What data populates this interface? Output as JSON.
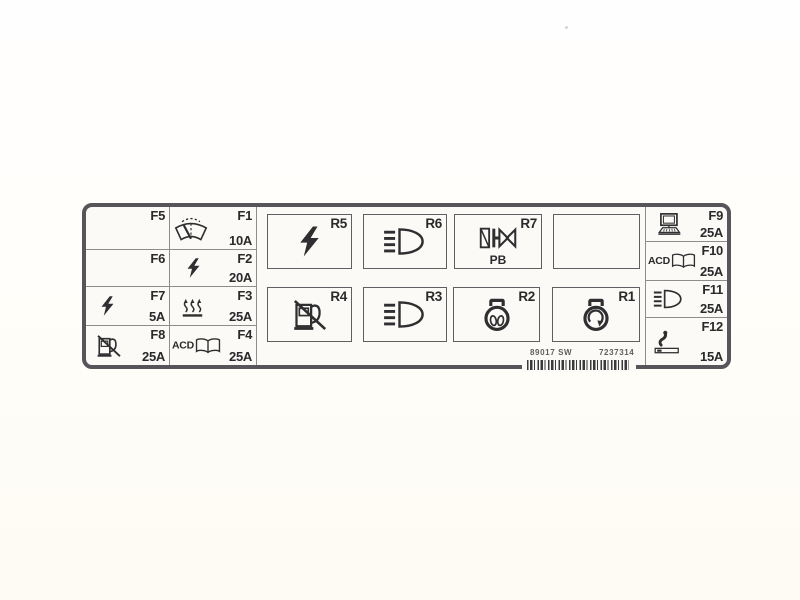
{
  "colors": {
    "panel_border": "#55555a",
    "grid_line": "#8d8d8d",
    "ink": "#2f2f31",
    "panel_bg": "#fbfaf6",
    "page_bg": "#fffefa",
    "code_text": "#5f5f5f"
  },
  "fuses": {
    "f5": {
      "label": "F5",
      "amp": ""
    },
    "f1": {
      "label": "F1",
      "amp": "10A"
    },
    "f6": {
      "label": "F6",
      "amp": ""
    },
    "f2": {
      "label": "F2",
      "amp": "20A"
    },
    "f7": {
      "label": "F7",
      "amp": "5A"
    },
    "f3": {
      "label": "F3",
      "amp": "25A"
    },
    "f8": {
      "label": "F8",
      "amp": "25A"
    },
    "f4": {
      "label": "F4",
      "amp": "25A",
      "icon_text": "ACD"
    },
    "f9": {
      "label": "F9",
      "amp": "25A"
    },
    "f10": {
      "label": "F10",
      "amp": "25A",
      "icon_text": "ACD"
    },
    "f11": {
      "label": "F11",
      "amp": "25A"
    },
    "f12": {
      "label": "F12",
      "amp": "15A"
    }
  },
  "relays": {
    "r5": {
      "label": "R5"
    },
    "r6": {
      "label": "R6"
    },
    "r7": {
      "label": "R7",
      "sub": "PB"
    },
    "r4": {
      "label": "R4"
    },
    "r3": {
      "label": "R3"
    },
    "r2": {
      "label": "R2"
    },
    "r1": {
      "label": "R1"
    }
  },
  "footer": {
    "code_left": "89017 SW",
    "code_right": "7237314"
  },
  "icons": {
    "f1": "windshield-wiper-washer",
    "f2": "lightning",
    "f3": "heater",
    "f4": "acd-book",
    "f7": "lightning",
    "f8": "fuel-pump-off",
    "f9": "computer",
    "f10": "acd-book",
    "f11": "headlight",
    "f12": "cigarette-lighter",
    "r1": "rotating-lamp",
    "r2": "dual-filament-bulb",
    "r3": "headlight",
    "r4": "fuel-pump-off",
    "r5": "lightning",
    "r6": "headlight",
    "r7": "solenoid-valve"
  }
}
